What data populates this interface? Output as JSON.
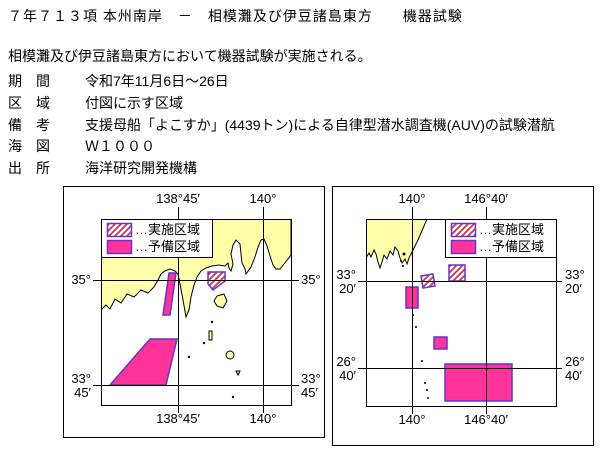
{
  "document": {
    "title": "７年７１３項 本州南岸　－　相模灘及び伊豆諸島東方　　機器試験",
    "summary": "相模灘及び伊豆諸島東方において機器試験が実施される。",
    "fields": {
      "period": {
        "label": "期　間",
        "value": "令和7年11月6日～26日"
      },
      "area": {
        "label": "区　域",
        "value": "付図に示す区域"
      },
      "remarks": {
        "label": "備　考",
        "value": "支援母船「よこすか」(4439トン)による自律型潜水調査機(AUV)の試験潜航"
      },
      "chart": {
        "label": "海　図",
        "value": "Ｗ１０００"
      },
      "source": {
        "label": "出　所",
        "value": "海洋研究開発機構"
      }
    }
  },
  "legend": {
    "hatched": "…実施区域",
    "solid": "…予備区域"
  },
  "left_map": {
    "lon1": "138°45′",
    "lon2": "140°",
    "lat1": "35°",
    "lat2_deg": "33°",
    "lat2_min": "45′"
  },
  "right_map": {
    "lon1": "140°",
    "lon2": "146°40′",
    "lat1_deg": "33°",
    "lat1_min": "20′",
    "lat2_deg": "26°",
    "lat2_min": "40′"
  },
  "colors": {
    "land": "#FFFFAA",
    "reserve_fill": "#FF3399",
    "hatch_stroke": "#CC3355",
    "area_border": "#6633CC",
    "grid": "#000000"
  }
}
